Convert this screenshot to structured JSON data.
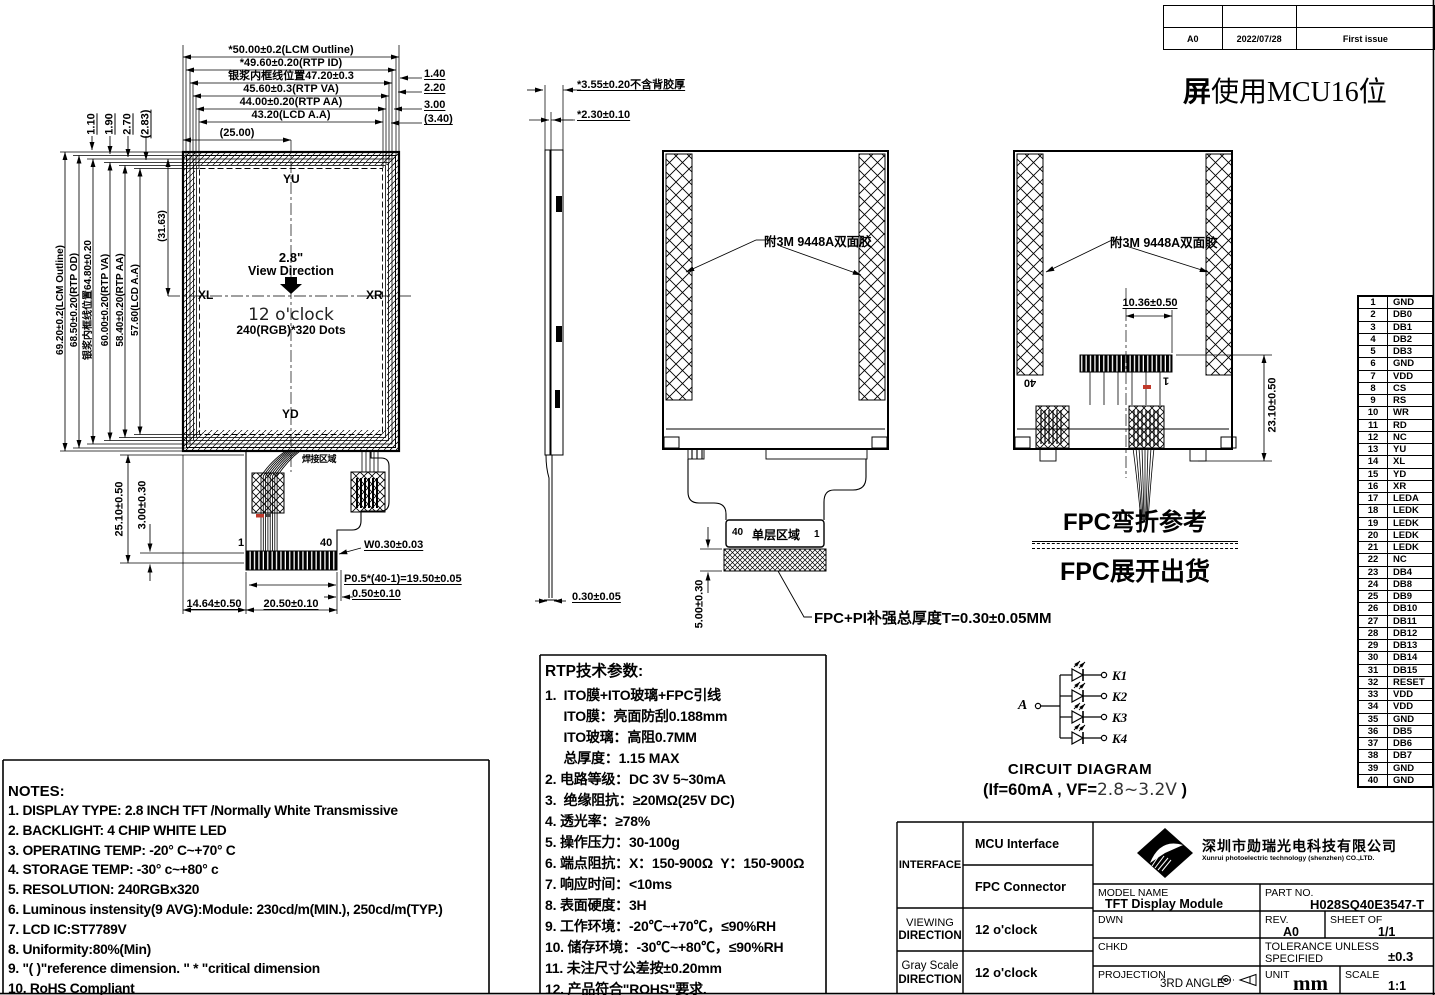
{
  "sheet": {
    "bg": "#ffffff",
    "ink": "#000000",
    "accent_red": "#c0392b"
  },
  "rev_table": {
    "rev": "A0",
    "date": "2022/07/28",
    "description": "First issue"
  },
  "header_note": {
    "bold": "屏",
    "rest": "使用MCU16位"
  },
  "front_view": {
    "top_dims": [
      "*50.00±0.2(LCM Outline)",
      "*49.60±0.20(RTP ID)",
      "银浆内框线位置47.20±0.3",
      "45.60±0.3(RTP VA)",
      "44.00±0.20(RTP AA)",
      "43.20(LCD A.A)",
      "(25.00)"
    ],
    "right_dims": [
      "1.40",
      "2.20",
      "3.00",
      "(3.40)"
    ],
    "top_left_dims": [
      "1.10",
      "1.90",
      "2.70",
      "(2.83)"
    ],
    "left_dims": [
      "69.20±0.2(LCM Outline)",
      "68.50±0.20(RTP OD)",
      "银浆内框线位置64.80±0.20",
      "60.00±0.20(RTP VA)",
      "58.40±0.20(RTP AA)",
      "57.60(LCD A.A)",
      "(31.63)"
    ],
    "marks": {
      "top": "YU",
      "bottom": "YD",
      "left": "XL",
      "right": "XR"
    },
    "center": {
      "size": "2.8\"",
      "view_direction": "View Direction",
      "clock": "12 o'clock",
      "dots": "240(RGB)*320 Dots"
    },
    "solder_text": "焊接区域",
    "pin_first": "1",
    "pin_last": "40",
    "bottom_dims": {
      "height_total": "25.10±0.50",
      "height_tab": "3.00±0.30",
      "finger_width": "W0.30±0.03",
      "pitch": "P0.5*(40-1)=19.50±0.05",
      "edge_margin": "0.50±0.10",
      "left_offset": "14.64±0.50",
      "tail_width": "20.50±0.10"
    }
  },
  "side_view": {
    "thickness_total": "*3.55±0.20不含背胶厚",
    "thickness_lcd": "*2.30±0.10",
    "fpc_thickness": "0.30±0.05"
  },
  "back_open_view": {
    "tape_label": "附3M 9448A双面胶",
    "pin_last": "40",
    "single_layer": "单层区域",
    "pin_first": "1",
    "tail_len": "5.00±0.30",
    "stiffener_note": "FPC+PI补强总厚度T=0.30±0.05MM"
  },
  "back_folded_view": {
    "tape_label": "附3M 9448A双面胶",
    "fold_width": "10.36±0.50",
    "fold_height": "23.10±0.50",
    "pin_last": "40",
    "pin_first": "1"
  },
  "fpc_caption": {
    "line1": "FPC弯折参考",
    "line2": "FPC展开出货"
  },
  "pin_table": [
    {
      "no": "1",
      "name": "GND"
    },
    {
      "no": "2",
      "name": "DB0"
    },
    {
      "no": "3",
      "name": "DB1"
    },
    {
      "no": "4",
      "name": "DB2"
    },
    {
      "no": "5",
      "name": "DB3"
    },
    {
      "no": "6",
      "name": "GND"
    },
    {
      "no": "7",
      "name": "VDD"
    },
    {
      "no": "8",
      "name": "CS"
    },
    {
      "no": "9",
      "name": "RS"
    },
    {
      "no": "10",
      "name": "WR"
    },
    {
      "no": "11",
      "name": "RD"
    },
    {
      "no": "12",
      "name": "NC"
    },
    {
      "no": "13",
      "name": "YU"
    },
    {
      "no": "14",
      "name": "XL"
    },
    {
      "no": "15",
      "name": "YD"
    },
    {
      "no": "16",
      "name": "XR"
    },
    {
      "no": "17",
      "name": "LEDA"
    },
    {
      "no": "18",
      "name": "LEDK"
    },
    {
      "no": "19",
      "name": "LEDK"
    },
    {
      "no": "20",
      "name": "LEDK"
    },
    {
      "no": "21",
      "name": "LEDK"
    },
    {
      "no": "22",
      "name": "NC"
    },
    {
      "no": "23",
      "name": "DB4"
    },
    {
      "no": "24",
      "name": "DB8"
    },
    {
      "no": "25",
      "name": "DB9"
    },
    {
      "no": "26",
      "name": "DB10"
    },
    {
      "no": "27",
      "name": "DB11"
    },
    {
      "no": "28",
      "name": "DB12"
    },
    {
      "no": "29",
      "name": "DB13"
    },
    {
      "no": "30",
      "name": "DB14"
    },
    {
      "no": "31",
      "name": "DB15"
    },
    {
      "no": "32",
      "name": "RESET"
    },
    {
      "no": "33",
      "name": "VDD"
    },
    {
      "no": "34",
      "name": "VDD"
    },
    {
      "no": "35",
      "name": "GND"
    },
    {
      "no": "36",
      "name": "DB5"
    },
    {
      "no": "37",
      "name": "DB6"
    },
    {
      "no": "38",
      "name": "DB7"
    },
    {
      "no": "39",
      "name": "GND"
    },
    {
      "no": "40",
      "name": "GND"
    }
  ],
  "rtp_params": {
    "title": "RTP技术参数:",
    "lines": [
      "1.  ITO膜+ITO玻璃+FPC引线",
      "     ITO膜：亮面防刮0.188mm",
      "     ITO玻璃：高阻0.7MM",
      "     总厚度：1.15 MAX",
      "2. 电路等级：DC 3V 5~30mA",
      "3.  绝缘阻抗：≥20MΩ(25V DC)",
      "4. 透光率：≥78%",
      "5. 操作压力：30-100g",
      "6. 端点阻抗：X：150-900Ω  Y：150-900Ω",
      "7. 响应时间：<10ms",
      "8. 表面硬度：3H",
      "9. 工作环境：-20℃~+70℃，≤90%RH",
      "10. 储存环境：-30℃~+80℃，≤90%RH",
      "11. 未注尺寸公差按±0.20mm",
      "12. 产品符合\"ROHS\"要求."
    ]
  },
  "notes": {
    "title": "NOTES:",
    "lines": [
      "1. DISPLAY TYPE: 2.8 INCH TFT /Normally White Transmissive",
      "2. BACKLIGHT: 4 CHIP WHITE LED",
      "3. OPERATING TEMP: -20° C~+70° C",
      "4. STORAGE TEMP: -30° c~+80° c",
      "5. RESOLUTION: 240RGBx320",
      "6. Luminous instensity(9 AVG):Module: 230cd/m(MIN.), 250cd/m(TYP.)",
      "7. LCD IC:ST7789V",
      "8. Uniformity:80%(Min)",
      "9. \"( )\"reference dimension. \" * \"critical dimension",
      "10. RoHS Compliant"
    ]
  },
  "circuit": {
    "anode": "A",
    "cathodes": [
      "K1",
      "K2",
      "K3",
      "K4"
    ],
    "title": "CIRCUIT DIAGRAM",
    "spec_prefix": "(If=60mA , VF=",
    "spec_value": "2.8~3.2V",
    "spec_suffix": " )"
  },
  "title_block": {
    "interface_label": "INTERFACE",
    "interface_1": "MCU Interface",
    "interface_2": "FPC Connector",
    "viewing_label_1": "VIEWING",
    "viewing_label_2": "DIRECTION",
    "viewing_value": "12 o'clock",
    "gray_label_1": "Gray Scale",
    "gray_label_2": "DIRECTION",
    "gray_value": "12 o'clock",
    "company_cn": "深圳市勋瑞光电科技有限公司",
    "company_en": "Xunrui photoelectric technology (shenzhen) CO.,LTD.",
    "model_label": "MODEL NAME",
    "model_value": "TFT Display Module",
    "part_label": "PART NO.",
    "part_value": "H028SQ40E3547-T",
    "dwn_label": "DWN",
    "rev_label": "REV.",
    "rev_value": "A0",
    "sheet_label": "SHEET OF",
    "sheet_value": "1/1",
    "chkd_label": "CHKD",
    "tol_label_1": "TOLERANCE UNLESS",
    "tol_label_2": "SPECIFIED",
    "tol_value": "±0.3",
    "proj_label": "PROJECTION",
    "proj_value": "3RD ANGLE",
    "unit_label": "UNIT",
    "unit_value": "mm",
    "scale_label": "SCALE",
    "scale_value": "1:1"
  }
}
